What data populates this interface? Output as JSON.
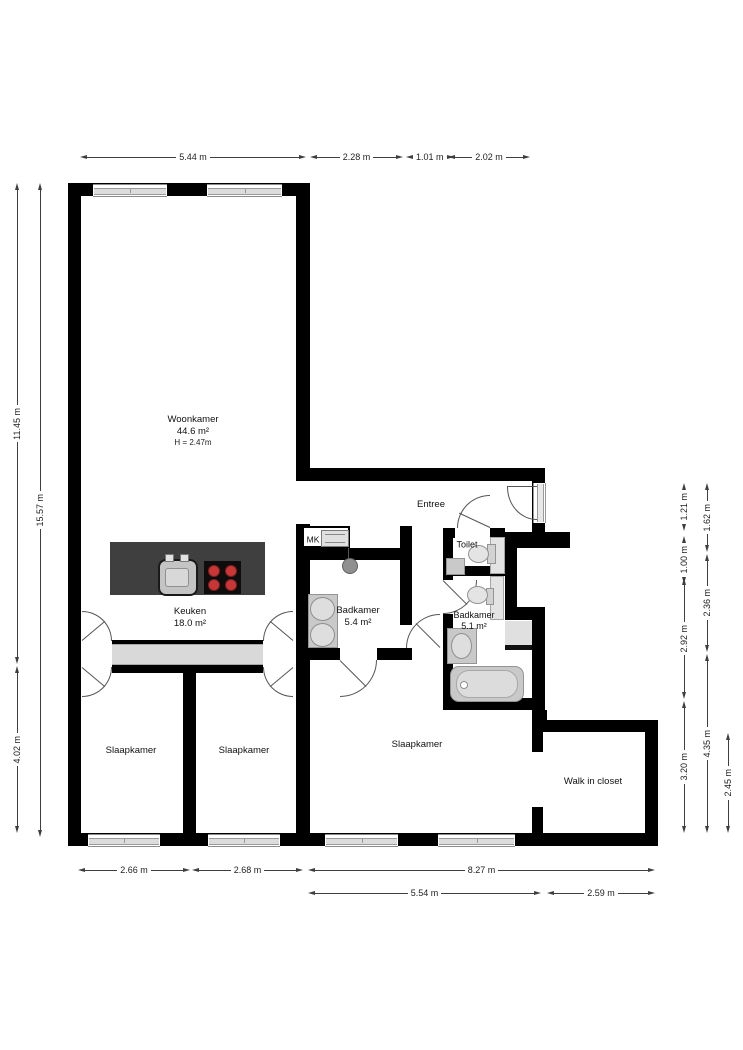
{
  "rooms": {
    "woonkamer": {
      "name": "Woonkamer",
      "area": "44.6 m²",
      "ceiling": "H = 2.47m"
    },
    "keuken": {
      "name": "Keuken",
      "area": "18.0 m²"
    },
    "entree": {
      "name": "Entree"
    },
    "mk": {
      "name": "MK"
    },
    "toilet": {
      "name": "Toilet"
    },
    "badkamer_1": {
      "name": "Badkamer",
      "area": "5.4 m²"
    },
    "badkamer_2": {
      "name": "Badkamer",
      "area": "5.1 m²"
    },
    "slaapkamer_1": {
      "name": "Slaapkamer"
    },
    "slaapkamer_2": {
      "name": "Slaapkamer"
    },
    "slaapkamer_3": {
      "name": "Slaapkamer"
    },
    "walk_in_closet": {
      "name": "Walk in closet"
    }
  },
  "dimensions": {
    "top": [
      "5.44 m",
      "2.28 m",
      "1.01 m",
      "2.02 m"
    ],
    "left": [
      "11.45 m",
      "15.57 m",
      "4.02 m"
    ],
    "right": [
      "1.21 m",
      "1.00 m",
      "2.92 m",
      "3.20 m",
      "1.62 m",
      "2.36 m",
      "4.35 m",
      "2.45 m"
    ],
    "bottom": [
      "2.66 m",
      "2.68 m",
      "8.27 m",
      "5.54 m",
      "2.59 m"
    ]
  },
  "colors": {
    "wall": "#000000",
    "dimension_line": "#3f3f3f",
    "corridor_fill": "#d9d9d9",
    "kitchen_island": "#3f3f3f",
    "stove_burner": "#c93636",
    "fixture_gray": "#e3e3e3"
  }
}
